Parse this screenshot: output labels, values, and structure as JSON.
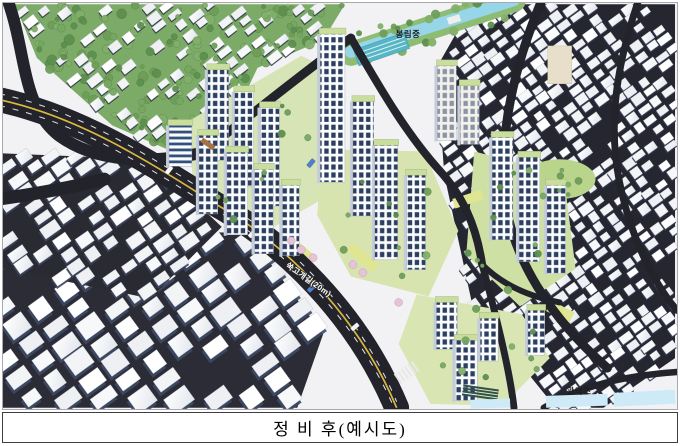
{
  "figure": {
    "caption": "정 비 후(예시도)"
  },
  "map_labels": {
    "school_top": "봉림중",
    "school_bottom": "관악초",
    "road": "쑥고개길(20m)"
  },
  "palette": {
    "road": "#23232c",
    "road_centerline": "#d9ba3e",
    "lane_dash": "#e6e6e6",
    "existing_building": "#f5f6f8",
    "building_shadow": "#3d4965",
    "tree_green": "#6f9e59",
    "hill_green": "#7cab67",
    "apartment_glass": "#2c3f60",
    "apartment_roof": "#c9dd9d",
    "landscape_green": "#d7e4b0",
    "ground_yellow": "#dfe591",
    "water_blue": "#96d6e8",
    "shallow_water": "#cfeaf7",
    "school_roof_teal": "#57b6c6"
  }
}
